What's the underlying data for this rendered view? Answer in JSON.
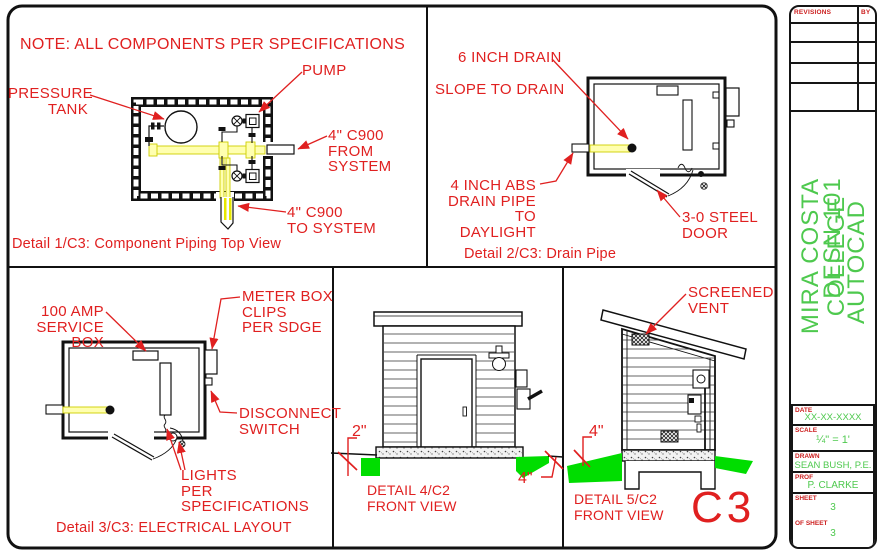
{
  "sheet": {
    "note": "NOTE: ALL COMPONENTS PER SPECIFICATIONS",
    "sheet_code": "C3"
  },
  "details": [
    {
      "id": "1",
      "caption": "Detail 1/C3: Component Piping Top View",
      "labels": {
        "pressure_tank": "PRESSURE\nTANK",
        "pump": "PUMP",
        "from_system": "4\" C900\nFROM\nSYSTEM",
        "to_system": "4\" C900\nTO SYSTEM"
      }
    },
    {
      "id": "2",
      "caption": "Detail 2/C3: Drain Pipe",
      "labels": {
        "drain": "6 INCH DRAIN",
        "slope": "SLOPE TO DRAIN",
        "drain_pipe": "4 INCH ABS\nDRAIN PIPE\nTO DAYLIGHT",
        "door": "3-0 STEEL\nDOOR"
      }
    },
    {
      "id": "3",
      "caption": "Detail 3/C3: ELECTRICAL LAYOUT",
      "labels": {
        "service_box": "100 AMP\nSERVICE BOX",
        "meter_box": "METER BOX\nCLIPS\nPER SDGE",
        "disconnect": "DISCONNECT\nSWITCH",
        "lights": "LIGHTS\nPER\nSPECIFICATIONS"
      }
    },
    {
      "id": "4",
      "caption": "DETAIL 4/C2\nFRONT VIEW",
      "labels": {
        "dim_left": "2\"",
        "dim_right": "4\""
      }
    },
    {
      "id": "5",
      "caption": "DETAIL 5/C2\nFRONT VIEW",
      "labels": {
        "vent": "SCREENED\nVENT",
        "dim": "4\""
      }
    }
  ],
  "title_block": {
    "revisions_label": "REVISIONS",
    "by_label": "BY",
    "college": "MIRA COSTA COLLEGE",
    "course": "DESN 101",
    "software": "AUTOCAD",
    "date": {
      "label": "DATE",
      "value": "XX-XX-XXXX"
    },
    "scale": {
      "label": "SCALE",
      "value": "¼\" = 1'"
    },
    "drawn": {
      "label": "DRAWN",
      "value": "SEAN BUSH, P.E."
    },
    "prof": {
      "label": "PROF",
      "value": "P. CLARKE"
    },
    "sheet": {
      "label": "SHEET",
      "value": "3"
    },
    "of_sheet": {
      "label": "OF SHEET",
      "value": "3"
    }
  },
  "colors": {
    "red": "#e02020",
    "green_text": "#4ec94e",
    "ground_green": "#00dd00"
  }
}
